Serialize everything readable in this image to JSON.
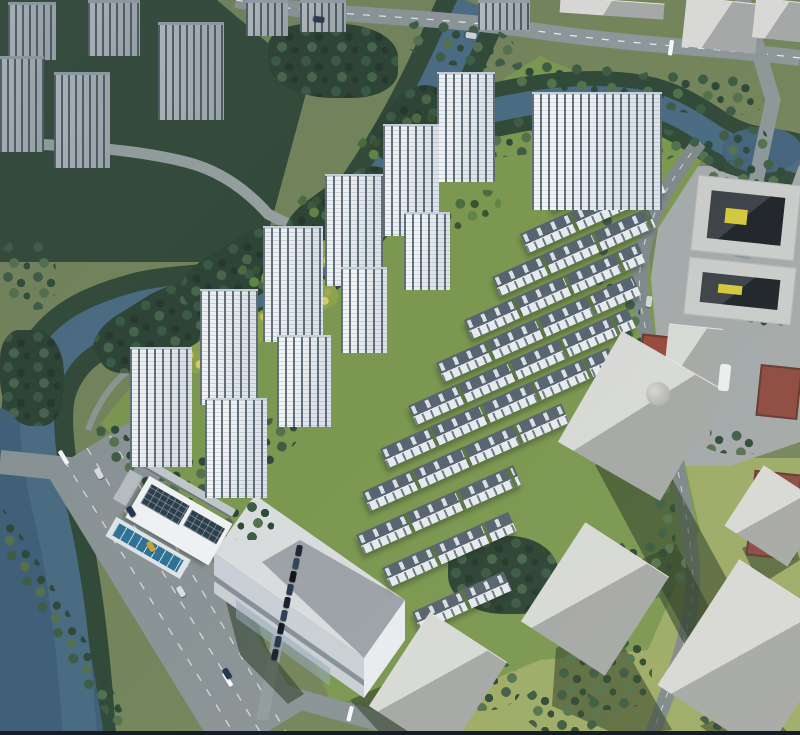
{
  "meta": {
    "description": "Aerial architectural rendering of a riverside residential development with high-rise towers, townhouse rows, canal, roads and gray context massing",
    "canvas_w": 800,
    "canvas_h": 735
  },
  "palette": {
    "base_green": "#74855c",
    "site_green": "#7b9750",
    "lawn": "#9dab67",
    "forest": "#2d4334",
    "water": "#4a6c83",
    "water_dark": "#40607a",
    "bank_trees": "#2e4737",
    "road": "#8a9395",
    "road_light": "#8d9799",
    "tower_face": "#eef1f3",
    "tower_roof": "#b5c2cd",
    "townhouse_roof": "#57636f",
    "gray_box_top": "#d8d9d7",
    "gray_box_side": "#a6a8a7",
    "court_red": "#96493b",
    "yellow_trees": "#cfc25c",
    "pool": "#2e7296",
    "solar": "#2f3f4a"
  },
  "towers": [
    {
      "x": 437,
      "y": 72,
      "w": 58,
      "h": 110
    },
    {
      "x": 383,
      "y": 124,
      "w": 56,
      "h": 112
    },
    {
      "x": 325,
      "y": 174,
      "w": 58,
      "h": 112
    },
    {
      "x": 263,
      "y": 226,
      "w": 60,
      "h": 116
    },
    {
      "x": 200,
      "y": 289,
      "w": 58,
      "h": 116
    },
    {
      "x": 130,
      "y": 347,
      "w": 62,
      "h": 120
    },
    {
      "x": 404,
      "y": 212,
      "w": 46,
      "h": 78
    },
    {
      "x": 341,
      "y": 267,
      "w": 46,
      "h": 86
    },
    {
      "x": 277,
      "y": 335,
      "w": 54,
      "h": 92
    },
    {
      "x": 205,
      "y": 398,
      "w": 62,
      "h": 100
    },
    {
      "x": 532,
      "y": 92,
      "w": 130,
      "h": 118
    }
  ],
  "context_towers": [
    {
      "x": 8,
      "y": 2,
      "w": 48,
      "h": 58
    },
    {
      "x": 88,
      "y": 0,
      "w": 52,
      "h": 56
    },
    {
      "x": 158,
      "y": 22,
      "w": 66,
      "h": 98
    },
    {
      "x": 0,
      "y": 56,
      "w": 44,
      "h": 96
    },
    {
      "x": 54,
      "y": 72,
      "w": 56,
      "h": 96
    },
    {
      "x": 246,
      "y": 0,
      "w": 42,
      "h": 36
    },
    {
      "x": 300,
      "y": 0,
      "w": 46,
      "h": 32
    },
    {
      "x": 478,
      "y": 0,
      "w": 52,
      "h": 30
    }
  ],
  "townhouse_rows": [
    {
      "x": 545,
      "y": 192,
      "len": 115
    },
    {
      "x": 520,
      "y": 234,
      "len": 150
    },
    {
      "x": 492,
      "y": 277,
      "len": 170
    },
    {
      "x": 464,
      "y": 320,
      "len": 190
    },
    {
      "x": 436,
      "y": 363,
      "len": 215
    },
    {
      "x": 408,
      "y": 406,
      "len": 240
    },
    {
      "x": 380,
      "y": 449,
      "len": 250
    },
    {
      "x": 362,
      "y": 492,
      "len": 218
    },
    {
      "x": 356,
      "y": 535,
      "len": 172
    },
    {
      "x": 382,
      "y": 568,
      "len": 138
    },
    {
      "x": 412,
      "y": 612,
      "len": 100
    }
  ],
  "gray_boxes": [
    {
      "x": 684,
      "y": 0,
      "w": 74,
      "h": 50,
      "rot": 6
    },
    {
      "x": 754,
      "y": 0,
      "w": 52,
      "h": 40,
      "rot": 6
    },
    {
      "x": 560,
      "y": 0,
      "w": 104,
      "h": 16,
      "rot": 4
    },
    {
      "x": 666,
      "y": 326,
      "w": 54,
      "h": 56,
      "rot": 6
    },
    {
      "x": 658,
      "y": 388,
      "w": 54,
      "h": 52,
      "rot": 6
    },
    {
      "x": 582,
      "y": 352,
      "w": 118,
      "h": 128,
      "rot": 30
    },
    {
      "x": 545,
      "y": 540,
      "w": 100,
      "h": 118,
      "rot": 33
    },
    {
      "x": 688,
      "y": 582,
      "w": 128,
      "h": 150,
      "rot": 33
    },
    {
      "x": 738,
      "y": 480,
      "w": 75,
      "h": 72,
      "rot": 33
    },
    {
      "x": 392,
      "y": 628,
      "w": 92,
      "h": 112,
      "rot": 33
    }
  ],
  "rings": [
    {
      "x": 694,
      "y": 180,
      "w": 104,
      "h": 76,
      "rot": 6
    },
    {
      "x": 686,
      "y": 262,
      "w": 108,
      "h": 58,
      "rot": 6
    }
  ],
  "cylinders": [
    {
      "x": 646,
      "y": 382,
      "w": 24,
      "h": 24
    }
  ],
  "courts": [
    {
      "x": 640,
      "y": 336,
      "w": 50,
      "h": 40,
      "rot": 6,
      "color": "#96493b"
    },
    {
      "x": 758,
      "y": 366,
      "w": 42,
      "h": 52,
      "rot": 6,
      "color": "#8e4a40"
    },
    {
      "x": 750,
      "y": 472,
      "w": 48,
      "h": 86,
      "rot": 6,
      "color": "#8a4a45"
    }
  ],
  "yellow_strips": [
    {
      "x": 180,
      "y": 352,
      "w": 168,
      "h": 28,
      "rot": -27
    },
    {
      "x": 258,
      "y": 274,
      "w": 140,
      "h": 24,
      "rot": -27
    },
    {
      "x": 348,
      "y": 206,
      "w": 92,
      "h": 20,
      "rot": -27
    },
    {
      "x": 420,
      "y": 136,
      "w": 70,
      "h": 18,
      "rot": -24
    }
  ],
  "groves": [
    {
      "x": 268,
      "y": 24,
      "w": 130,
      "h": 74,
      "rot": 0,
      "v": "g-dark"
    },
    {
      "x": 404,
      "y": 22,
      "w": 110,
      "h": 44,
      "rot": 6,
      "v": "g-mid"
    },
    {
      "x": 508,
      "y": 62,
      "w": 130,
      "h": 40,
      "rot": 4,
      "v": "g-mid"
    },
    {
      "x": 634,
      "y": 72,
      "w": 130,
      "h": 42,
      "rot": 4,
      "v": "g-mid"
    },
    {
      "x": 452,
      "y": 116,
      "w": 120,
      "h": 40,
      "rot": -6,
      "v": "g-mid"
    },
    {
      "x": 572,
      "y": 128,
      "w": 110,
      "h": 38,
      "rot": -6,
      "v": "g-mid"
    },
    {
      "x": 688,
      "y": 128,
      "w": 80,
      "h": 34,
      "rot": -12,
      "v": "g-mid"
    },
    {
      "x": 92,
      "y": 296,
      "w": 130,
      "h": 66,
      "rot": -32,
      "v": "g-dark"
    },
    {
      "x": 178,
      "y": 240,
      "w": 130,
      "h": 60,
      "rot": -32,
      "v": "g-dark"
    },
    {
      "x": 282,
      "y": 182,
      "w": 120,
      "h": 56,
      "rot": -36,
      "v": "g-dark"
    },
    {
      "x": 368,
      "y": 96,
      "w": 90,
      "h": 60,
      "rot": -50,
      "v": "g-dark"
    },
    {
      "x": 0,
      "y": 330,
      "w": 64,
      "h": 96,
      "rot": 0,
      "v": "g-dark"
    },
    {
      "x": 0,
      "y": 240,
      "w": 56,
      "h": 70,
      "rot": 0,
      "v": "g-mid"
    },
    {
      "x": 116,
      "y": 414,
      "w": 30,
      "h": 108,
      "rot": -31,
      "v": "g-mid"
    },
    {
      "x": 30,
      "y": 448,
      "w": 28,
      "h": 300,
      "rot": -31,
      "v": "g-mid"
    },
    {
      "x": 596,
      "y": 184,
      "w": 24,
      "h": 118,
      "rot": 8,
      "v": "g-mid"
    },
    {
      "x": 618,
      "y": 298,
      "w": 22,
      "h": 128,
      "rot": 4,
      "v": "g-mid"
    },
    {
      "x": 652,
      "y": 436,
      "w": 22,
      "h": 118,
      "rot": -4,
      "v": "g-mid"
    },
    {
      "x": 700,
      "y": 156,
      "w": 92,
      "h": 30,
      "rot": 4,
      "v": "g-mid"
    },
    {
      "x": 408,
      "y": 655,
      "w": 112,
      "h": 56,
      "rot": 0,
      "v": "g-mid"
    },
    {
      "x": 448,
      "y": 536,
      "w": 110,
      "h": 78,
      "rot": 0,
      "v": "g-dark"
    },
    {
      "x": 556,
      "y": 636,
      "w": 96,
      "h": 74,
      "rot": 0,
      "v": "g-clump"
    },
    {
      "x": 612,
      "y": 540,
      "w": 74,
      "h": 58,
      "rot": 0,
      "v": "g-clump"
    },
    {
      "x": 696,
      "y": 684,
      "w": 94,
      "h": 50,
      "rot": 0,
      "v": "g-clump"
    },
    {
      "x": 748,
      "y": 596,
      "w": 50,
      "h": 64,
      "rot": 0,
      "v": "g-clump"
    },
    {
      "x": 524,
      "y": 688,
      "w": 76,
      "h": 46,
      "rot": 0,
      "v": "g-clump"
    },
    {
      "x": 738,
      "y": 296,
      "w": 54,
      "h": 30,
      "rot": 6,
      "v": "g-mid"
    },
    {
      "x": 698,
      "y": 428,
      "w": 62,
      "h": 26,
      "rot": 6,
      "v": "g-mid"
    },
    {
      "x": 154,
      "y": 436,
      "w": 150,
      "h": 48,
      "rot": -28,
      "v": "g-mid"
    },
    {
      "x": 214,
      "y": 500,
      "w": 60,
      "h": 40,
      "rot": 0,
      "v": "g-mid"
    },
    {
      "x": 356,
      "y": 118,
      "w": 96,
      "h": 42,
      "rot": -24,
      "v": "g-site"
    },
    {
      "x": 296,
      "y": 178,
      "w": 86,
      "h": 38,
      "rot": -24,
      "v": "g-site"
    },
    {
      "x": 236,
      "y": 248,
      "w": 84,
      "h": 38,
      "rot": -24,
      "v": "g-site"
    },
    {
      "x": 426,
      "y": 196,
      "w": 76,
      "h": 32,
      "rot": -24,
      "v": "g-site"
    }
  ],
  "cars": [
    {
      "x": 128,
      "y": 506,
      "color": "#223650",
      "rot": -31
    },
    {
      "x": 148,
      "y": 541,
      "color": "#c7a13a",
      "rot": -31
    },
    {
      "x": 178,
      "y": 586,
      "color": "#d9dde0",
      "rot": -31
    },
    {
      "x": 224,
      "y": 668,
      "color": "#223650",
      "rot": -31
    },
    {
      "x": 96,
      "y": 468,
      "color": "#d9dde0",
      "rot": -31
    },
    {
      "x": 316,
      "y": 14,
      "color": "#27394e",
      "rot": 96
    },
    {
      "x": 468,
      "y": 30,
      "color": "#d0d5d8",
      "rot": 98
    },
    {
      "x": 646,
      "y": 296,
      "color": "#d0d5d8",
      "rot": 8
    },
    {
      "x": 296,
      "y": 545,
      "color": "#1d2836",
      "rot": 11
    },
    {
      "x": 293,
      "y": 558,
      "color": "#33445a",
      "rot": 11
    },
    {
      "x": 290,
      "y": 571,
      "color": "#10151c",
      "rot": 11
    },
    {
      "x": 287,
      "y": 584,
      "color": "#2a3a4e",
      "rot": 11
    },
    {
      "x": 284,
      "y": 597,
      "color": "#171f2a",
      "rot": 11
    },
    {
      "x": 281,
      "y": 610,
      "color": "#2e3f54",
      "rot": 11
    },
    {
      "x": 278,
      "y": 623,
      "color": "#121820",
      "rot": 11
    },
    {
      "x": 275,
      "y": 636,
      "color": "#263649",
      "rot": 11
    },
    {
      "x": 272,
      "y": 649,
      "color": "#1a2430",
      "rot": 11
    }
  ],
  "crosswalks": [
    {
      "x": 58,
      "y": 452,
      "rot": -31,
      "count": 8
    },
    {
      "x": 222,
      "y": 674,
      "rot": -31,
      "count": 8
    },
    {
      "x": 350,
      "y": 706,
      "rot": 14,
      "count": 7
    },
    {
      "x": 670,
      "y": 40,
      "rot": 8,
      "count": 5
    }
  ]
}
